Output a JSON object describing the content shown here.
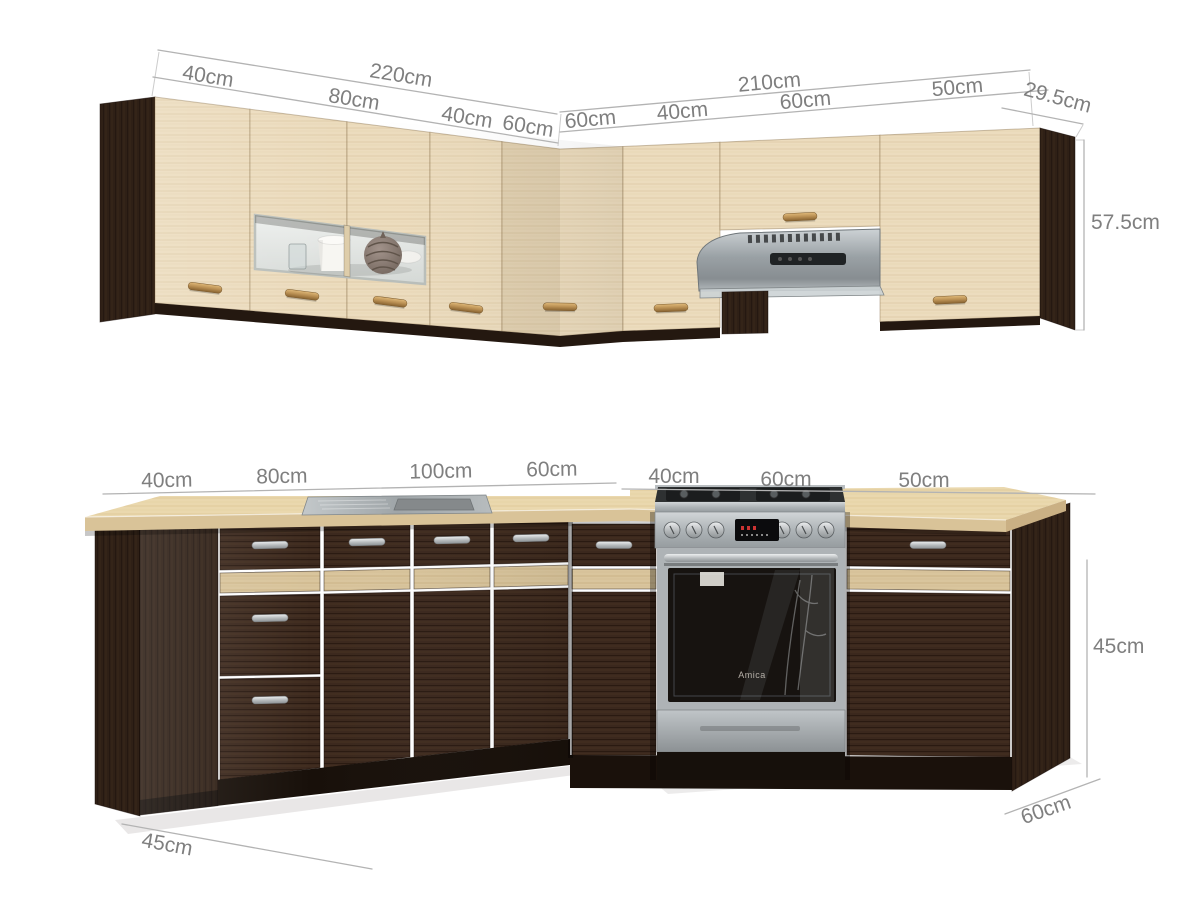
{
  "dimensions": {
    "upper": {
      "left_total": "220cm",
      "left_segments": [
        "40cm",
        "80cm",
        "40cm",
        "60cm"
      ],
      "right_total": "210cm",
      "right_segments": [
        "60cm",
        "40cm",
        "60cm",
        "50cm"
      ],
      "depth": "29.5cm",
      "height": "57.5cm"
    },
    "lower": {
      "left_segments": [
        "40cm",
        "80cm",
        "100cm",
        "60cm"
      ],
      "right_segments": [
        "40cm",
        "60cm",
        "50cm"
      ],
      "left_depth": "45cm",
      "height": "45cm",
      "right_depth": "60cm"
    }
  },
  "appliances": {
    "oven_brand": "Amica"
  },
  "colors": {
    "background": "#ffffff",
    "upper_door": "#ecdcbe",
    "base_cabinet": "#3b281d",
    "accent_strip": "#d9c59d",
    "countertop": "#ead8ae",
    "stainless": "#b0b6b9",
    "handle_brass": "#b98f53",
    "handle_silver": "#b9bcbe",
    "dimension_text": "#7f7f7f"
  }
}
